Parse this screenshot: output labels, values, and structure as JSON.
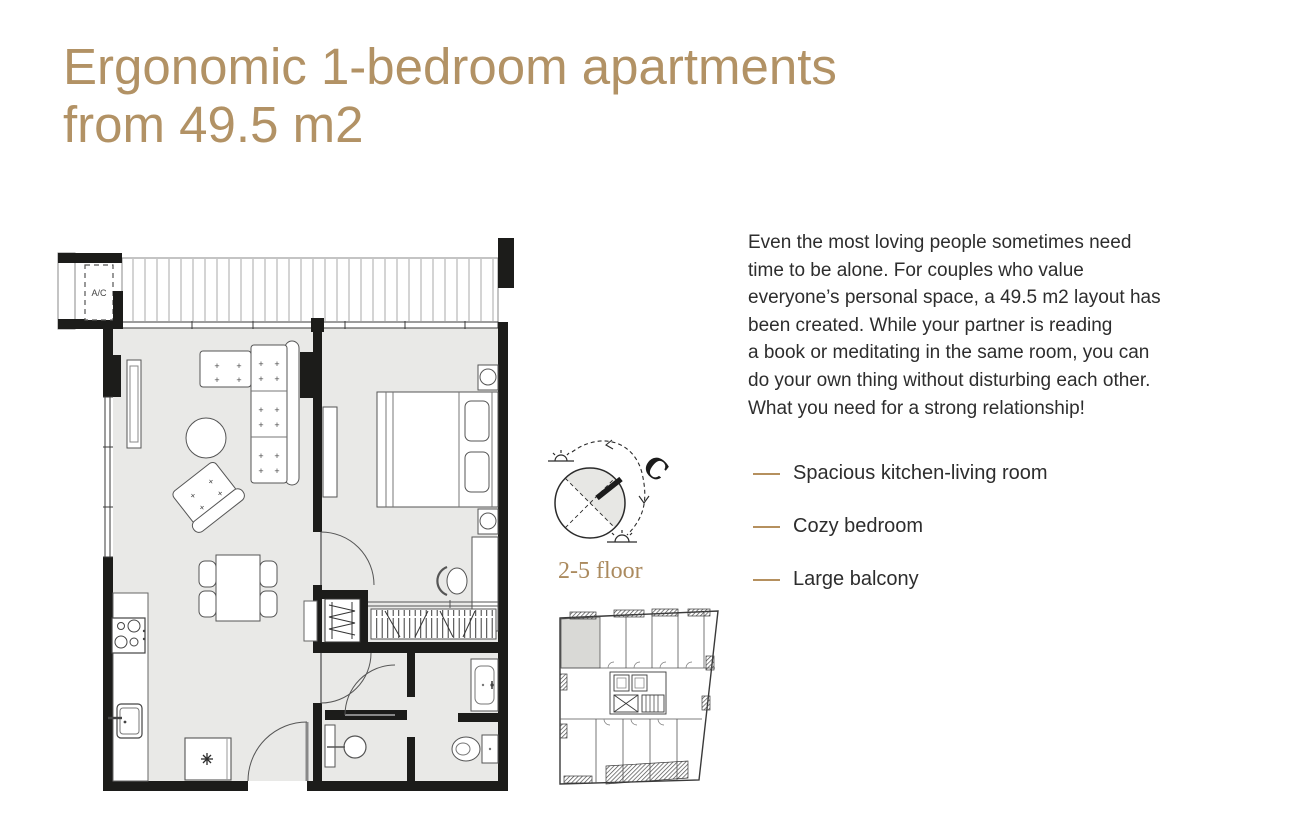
{
  "accent_color": "#b29265",
  "wall_color": "#1c1c1a",
  "floor_color": "#e9e9e7",
  "header": {
    "title_line1": "Ergonomic 1-bedroom apartments",
    "title_line2": "from 49.5 m2"
  },
  "main": {
    "description": "Even the most loving people sometimes need\ntime to be alone. For couples who value\neveryone’s personal space, a 49.5 m2 layout has\nbeen created. While your partner is reading\na book or meditating in the same room, you can\ndo your own thing without disturbing each other.\nWhat you need for a strong relationship!",
    "features": [
      "Spacious kitchen-living room",
      "Cozy bedroom",
      "Large balcony"
    ]
  },
  "plan": {
    "ac_label": "A/C",
    "north_label": "C",
    "floor_label": "2-5 floor"
  }
}
